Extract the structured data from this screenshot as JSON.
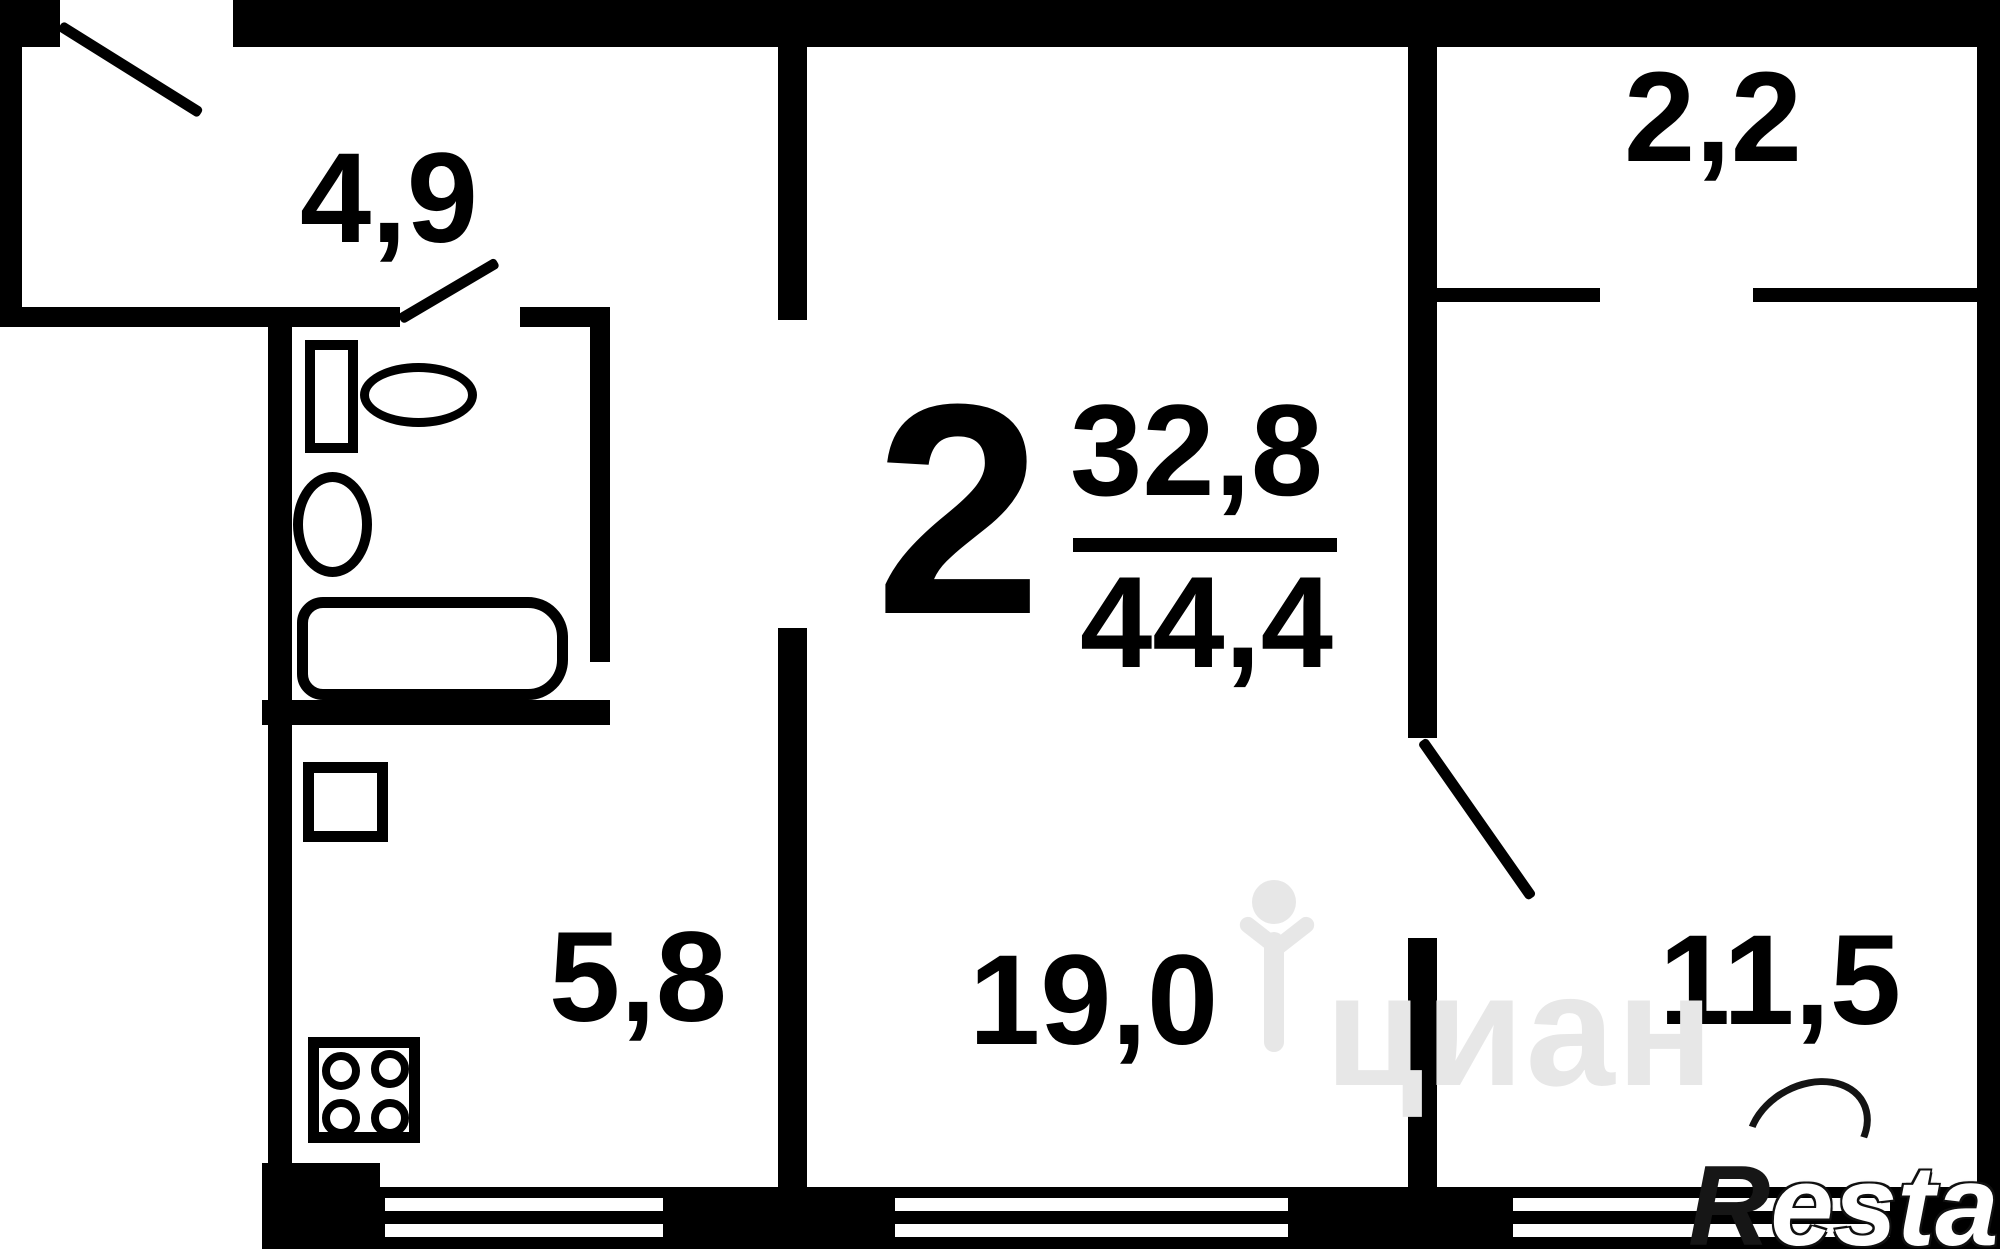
{
  "floor_plan": {
    "summary": {
      "rooms_count": "2",
      "living_area": "32,8",
      "total_area": "44,4"
    },
    "rooms": [
      {
        "name": "hallway",
        "area": "4,9"
      },
      {
        "name": "balcony",
        "area": "2,2"
      },
      {
        "name": "kitchen",
        "area": "5,8"
      },
      {
        "name": "living-room",
        "area": "19,0"
      },
      {
        "name": "bedroom",
        "area": "11,5"
      }
    ],
    "fixtures": [
      "toilet",
      "sink",
      "bathtub",
      "fridge",
      "stove"
    ],
    "watermarks": {
      "center_text": "циан",
      "corner_r": "R",
      "corner_rest": "estate"
    },
    "colors": {
      "wall": "#000000",
      "background": "#ffffff",
      "watermark_gray": "#e7e7e7"
    }
  }
}
